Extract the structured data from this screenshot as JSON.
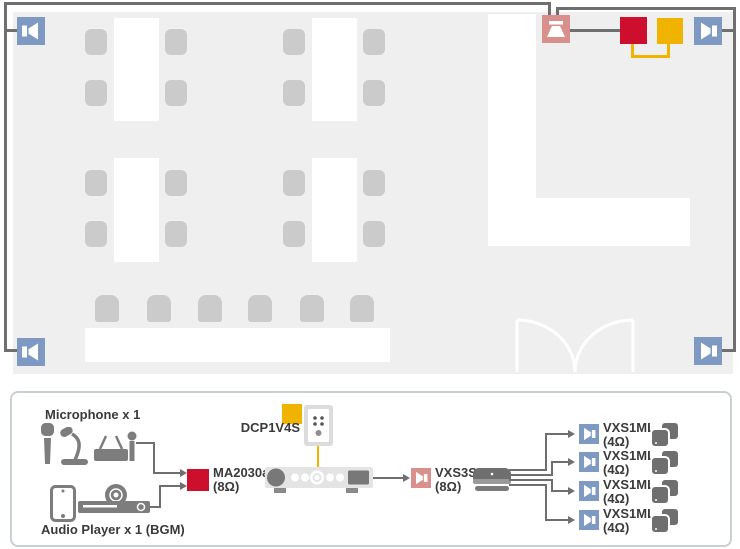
{
  "colors": {
    "speaker_blue": "#7E99C2",
    "sub_pink": "#D9908C",
    "amp_red": "#CE0E2D",
    "controller_yellow": "#F0B400",
    "wire_gray": "#6F6F6F",
    "floor_gray": "#EFEFEF",
    "furniture_gray": "#CBCBCB",
    "device_gray": "#7D7D7D"
  },
  "system": {
    "microphone_label": "Microphone x 1",
    "audio_player_label": "Audio Player x 1 (BGM)",
    "controller_label": "DCP1V4S",
    "amp": {
      "model": "MA2030a",
      "impedance": "(8Ω)"
    },
    "sub": {
      "model": "VXS3S",
      "impedance": "(8Ω)"
    },
    "outputs": [
      {
        "model": "VXS1ML",
        "impedance": "(4Ω)"
      },
      {
        "model": "VXS1ML",
        "impedance": "(4Ω)"
      },
      {
        "model": "VXS1ML",
        "impedance": "(4Ω)"
      },
      {
        "model": "VXS1ML",
        "impedance": "(4Ω)"
      }
    ]
  }
}
